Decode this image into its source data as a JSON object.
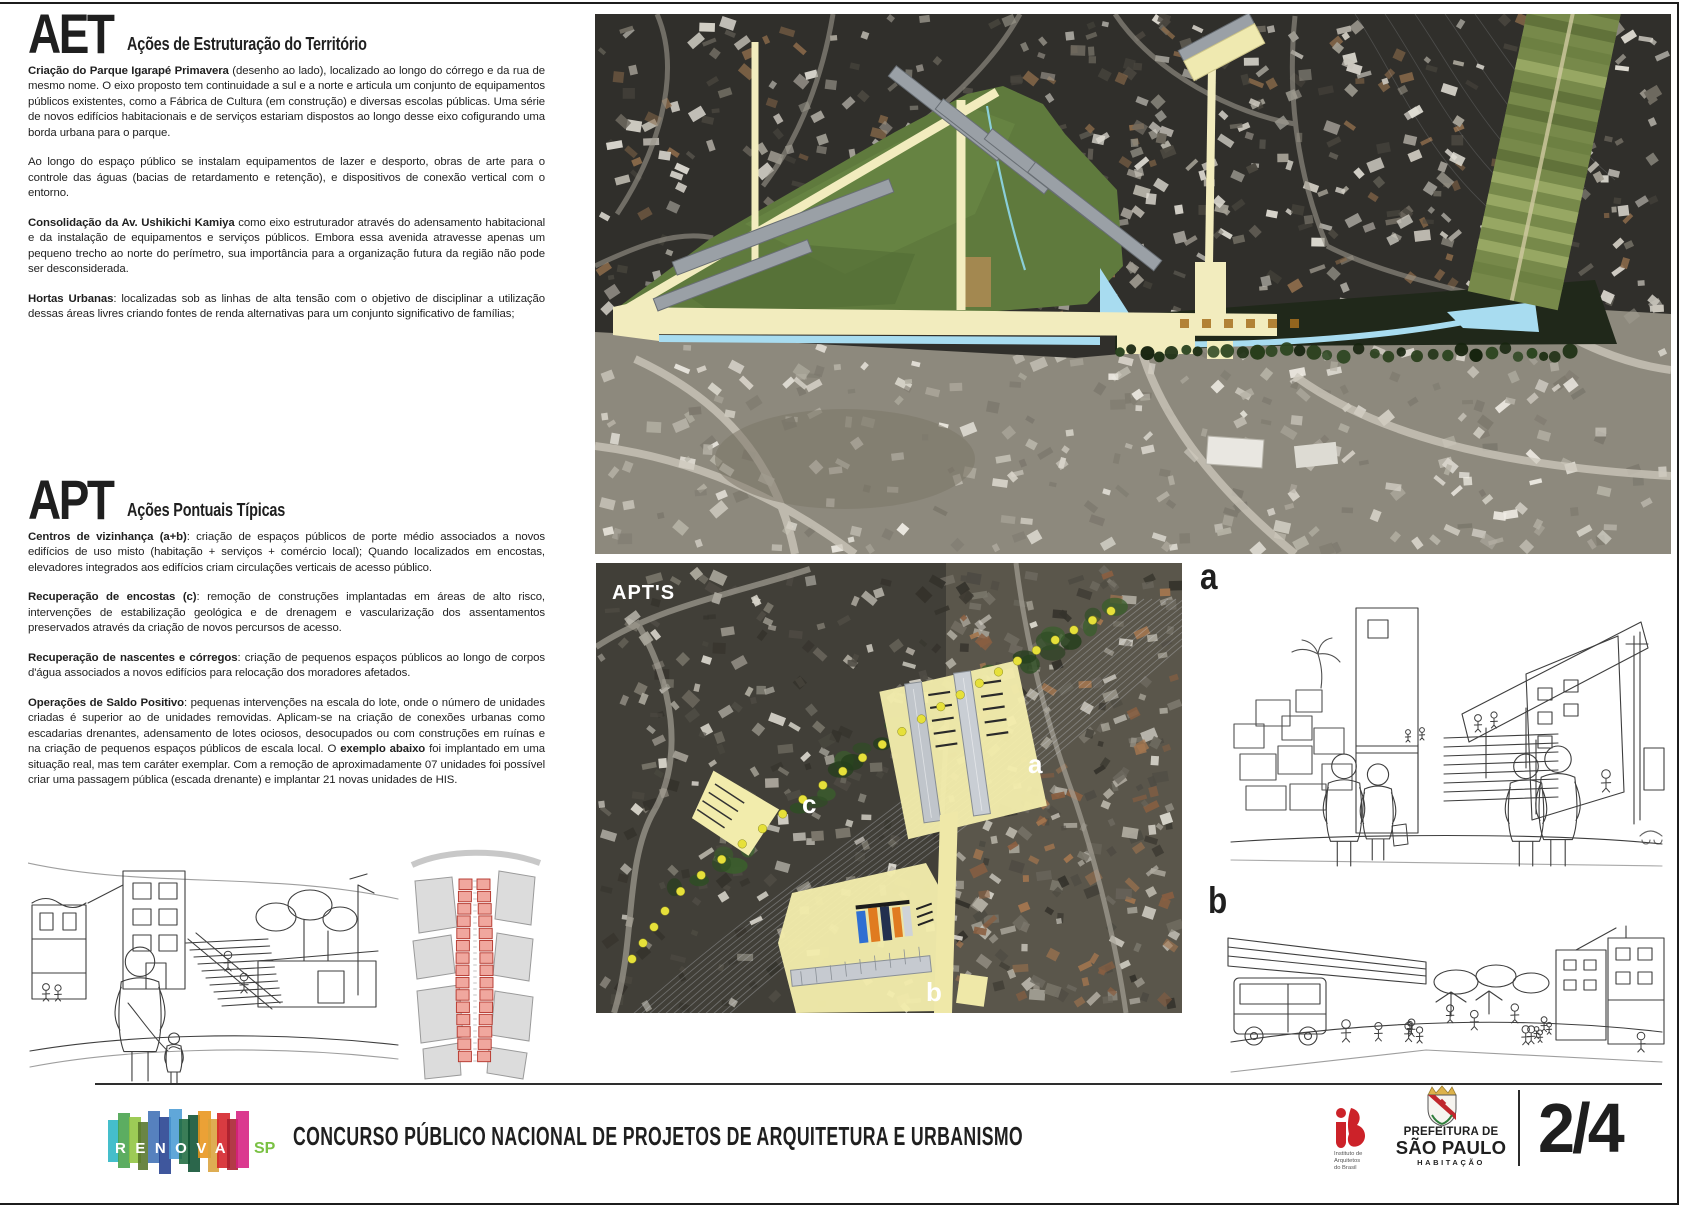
{
  "aet": {
    "code": "AET",
    "title": "Ações de Estruturação do Território",
    "p1_lead": "Criação do Parque Igarapé Primavera",
    "p1_text": " (desenho ao lado), localizado ao longo do córrego e da rua de mesmo nome. O eixo proposto tem continuidade a sul e a norte e articula um conjunto de equipamentos públicos existentes, como a Fábrica de Cultura (em construção) e diversas escolas públicas. Uma série de novos edifícios habitacionais e de serviços estariam dispostos ao longo desse eixo cofigurando uma borda urbana para o parque.",
    "p2_text": "Ao longo do espaço público se instalam equipamentos de lazer e desporto, obras de arte para o controle das águas (bacias de retardamento e retenção), e dispositivos de conexão vertical com o entorno.",
    "p3_lead": "Consolidação da Av. Ushikichi Kamiya",
    "p3_text": " como eixo estruturador através do adensamento habitacional e da instalação de equipamentos e serviços públicos. Embora essa avenida atravesse apenas um pequeno trecho ao norte do perímetro, sua importância para a organização futura da região não pode ser desconsiderada.",
    "p4_lead": "Hortas Urbanas",
    "p4_text": ": localizadas sob as linhas de alta tensão com o objetivo de disciplinar a utilização dessas áreas livres criando fontes de renda alternativas para um conjunto significativo de famílias;"
  },
  "apt": {
    "code": "APT",
    "title": "Ações Pontuais Típicas",
    "p1_lead": "Centros de vizinhança (a+b)",
    "p1_text": ": criação de espaços públicos de porte médio associados a novos edifícios de uso misto (habitação + serviços + comércio local); Quando localizados em encostas, elevadores integrados aos edifícios criam circulações verticais de acesso público.",
    "p2_lead": "Recuperação de encostas (c)",
    "p2_text": ": remoção de construções implantadas em áreas de alto risco, intervenções de estabilização geológica e de drenagem e vascularização dos assentamentos preservados através da criação de novos percursos de acesso.",
    "p3_lead": "Recuperação de nascentes e córregos",
    "p3_text": ": criação de pequenos espaços públicos ao longo de corpos d'água associados a novos edifícios para relocação dos moradores afetados.",
    "p4_lead": "Operações de Saldo Positivo",
    "p4_text_a": ": pequenas intervenções na escala do lote, onde o número de unidades criadas é superior ao de unidades removidas. Aplicam-se na criação de conexões urbanas como escadarias drenantes, adensamento de lotes ociosos, desocupados ou com construções em ruínas e na criação de pequenos espaços públicos de escala local. O ",
    "p4_bold": "exemplo abaixo",
    "p4_text_b": " foi implantado em uma situação real, mas tem caráter exemplar. Com a remoção de aproximadamente 07 unidades foi possível criar uma passagem pública (escada drenante) e implantar 21 novas unidades de HIS."
  },
  "maps": {
    "middle": {
      "label": "APT'S",
      "marker_a": "a",
      "marker_b": "b",
      "marker_c": "c"
    }
  },
  "sketches": {
    "label_a": "a",
    "label_b": "b"
  },
  "footer": {
    "title": "CONCURSO PÚBLICO NACIONAL DE PROJETOS DE ARQUITETURA E URBANISMO",
    "logo": {
      "letters": "RENOVA",
      "suffix": "SP",
      "suffix_color": "#7ac143",
      "bar_colors": [
        "#2bb5c4",
        "#45a24b",
        "#8fc43f",
        "#55742a",
        "#3f6fb5",
        "#24408f",
        "#4a9bd4",
        "#1f6b40",
        "#0e5132",
        "#e8941a",
        "#d9a23b",
        "#d42027",
        "#a81f2d",
        "#d61f7f"
      ]
    },
    "iab": {
      "line1": "Instituto de",
      "line2": "Arquitetos",
      "line3": "do Brasil",
      "color": "#cc2229"
    },
    "prefeitura": {
      "line1": "PREFEITURA DE",
      "line2": "SÃO PAULO",
      "line3": "HABITAÇÃO"
    },
    "page_number": "2/4"
  },
  "colors": {
    "park_green": "#5f7a3d",
    "overlay_yellow": "#f2ecbe",
    "site_yellow": "#f2ecac",
    "water_cyan": "#a8dcf0",
    "dot_yellow": "#e6e03a",
    "plan_pink": "#f0a79e",
    "plan_pink_stroke": "#b3342a"
  }
}
